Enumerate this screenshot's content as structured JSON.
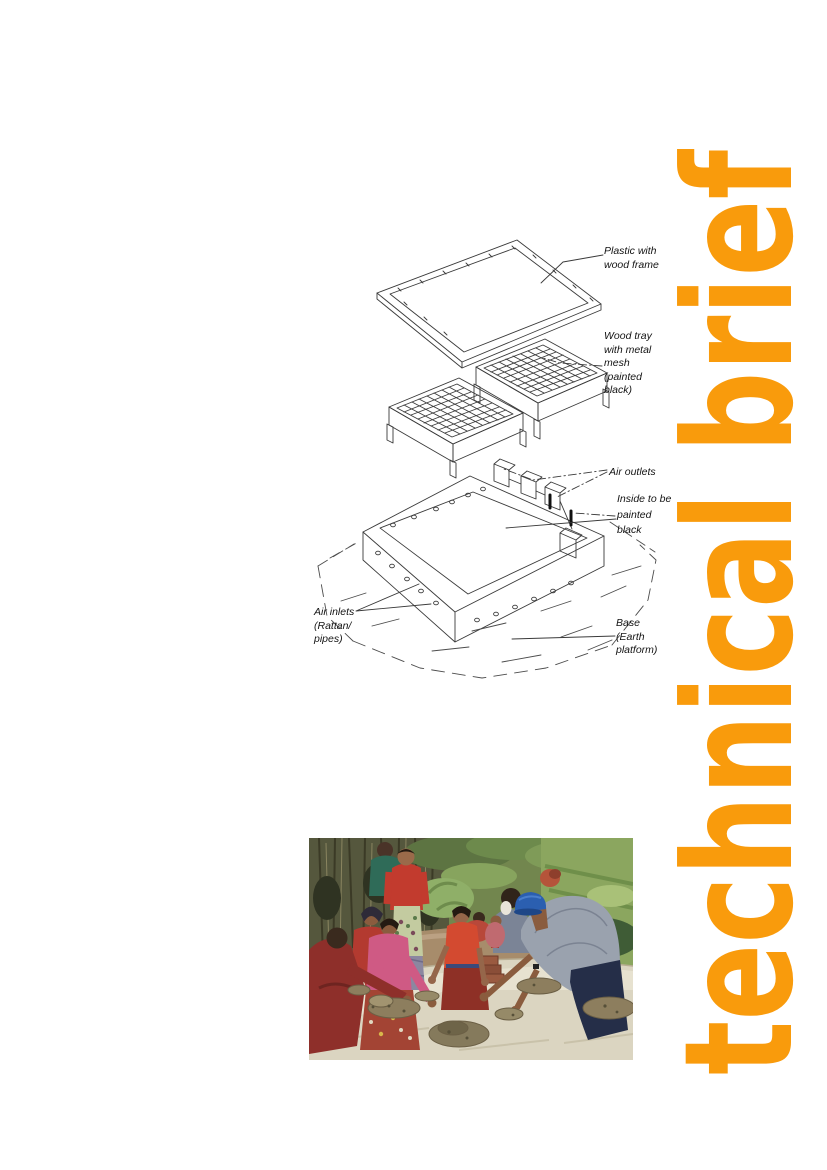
{
  "page": {
    "width": 827,
    "height": 1170,
    "background": "#ffffff"
  },
  "banner": {
    "text": "technical brief",
    "color": "#F99B0C"
  },
  "diagram": {
    "line_color": "#3a3a3a",
    "labels": {
      "plastic_with_wood_frame": "Plastic with\nwood frame",
      "wood_tray": "Wood tray\nwith metal\nmesh\n(painted\nblack)",
      "air_outlets": "Air outlets",
      "inside_painted_black": "Inside to be\npainted\nblack",
      "air_inlets": "Air inlets\n(Rattan/\npipes)",
      "base": "Base\n(Earth\nplatform)"
    }
  },
  "photo": {
    "description": "People shaping a mud earth platform outdoors",
    "palette": {
      "foliage": "#5d7442",
      "twigs": "#55573d",
      "dirt": "#a78c6b",
      "platform": "#dbd5c1",
      "mud": "#8d7e5e",
      "red_clothing": "#c23b2e",
      "pink_clothing": "#cf5a84",
      "gray_sweatshirt": "#9aa2ae",
      "blue_cap": "#2b5fb0"
    }
  }
}
